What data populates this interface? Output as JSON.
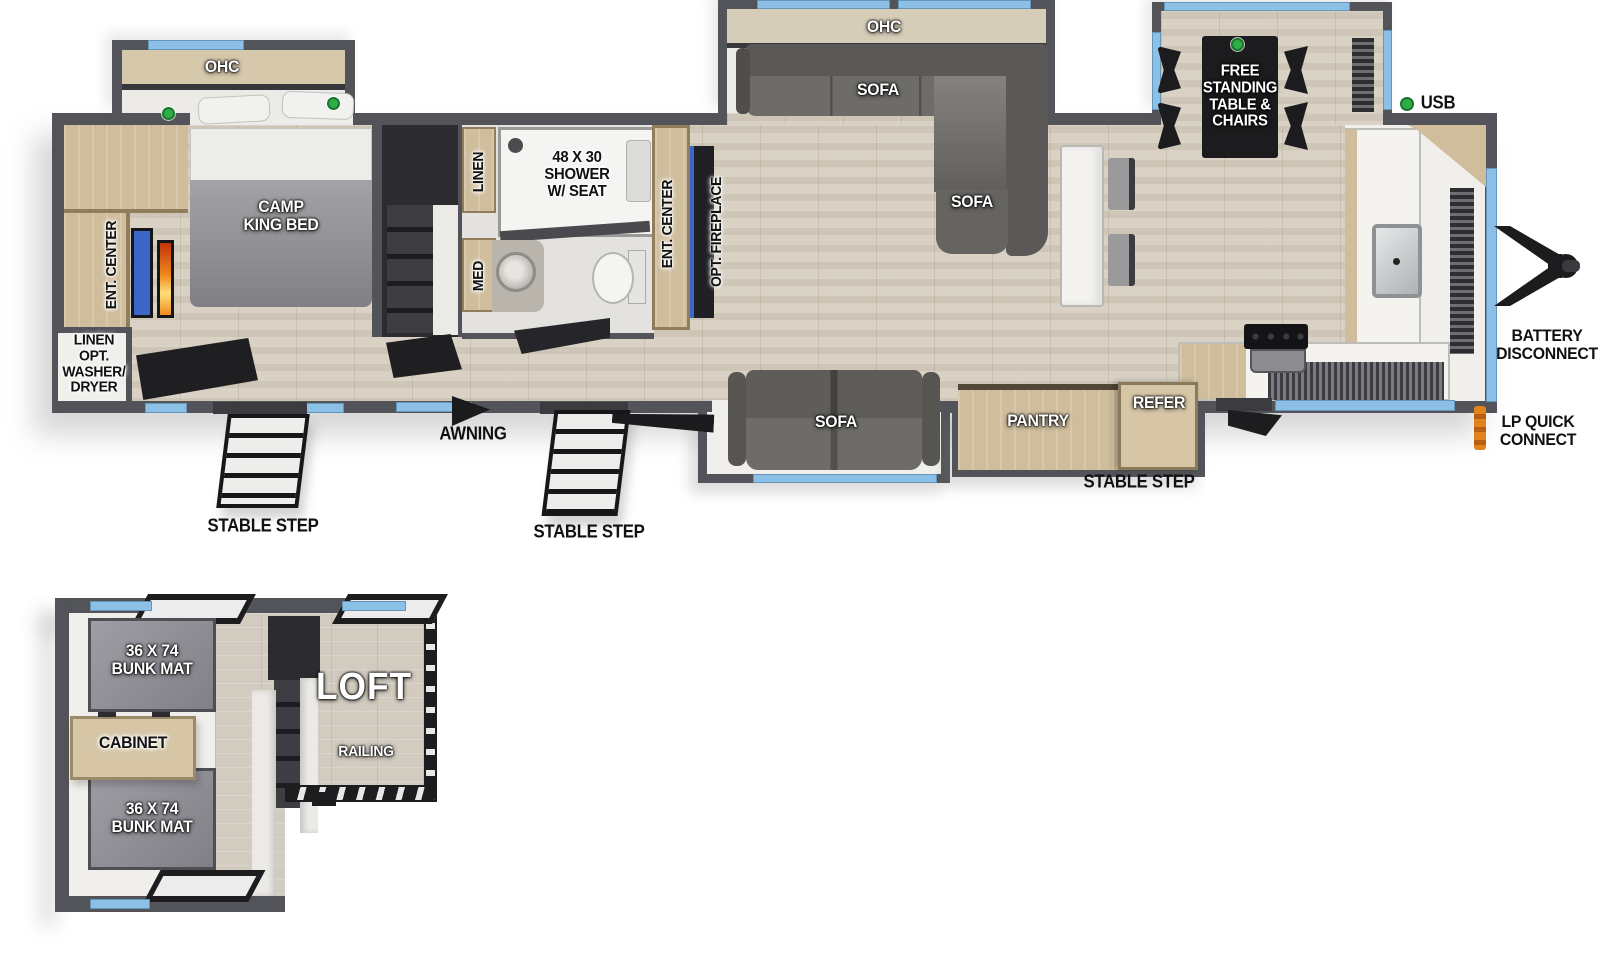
{
  "diagram": "travel-trailer-floorplan-two-levels",
  "colors": {
    "wall": "#535459",
    "window_blue": "#8cc0e6",
    "usb_green": "#2fae47",
    "wood_floor": "#d8d1c4",
    "cabinet_tan": "#cfbd9c",
    "sofa_gray": "#6e6c69",
    "bunk_gray": "#8e8e96",
    "table_black": "#1c1c1e",
    "fireplace_blue": "#3b66c9",
    "flame_orange": "#f08a1d",
    "lp_orange": "#e2821c"
  },
  "labels": {
    "ohc": "OHC",
    "camp_king_bed": "CAMP\nKING BED",
    "ent_center": "ENT. CENTER",
    "linen_opt_washer_dryer": "LINEN\nOPT.\nWASHER/\nDRYER",
    "linen": "LINEN",
    "med": "MED",
    "shower": "48 X 30\nSHOWER\nW/ SEAT",
    "opt_fireplace": "OPT. FIREPLACE",
    "sofa": "SOFA",
    "free_standing_table": "FREE\nSTANDING\nTABLE &\nCHAIRS",
    "usb": "USB",
    "pantry": "PANTRY",
    "refer": "REFER",
    "awning": "AWNING",
    "stable_step": "STABLE STEP",
    "battery_disconnect": "BATTERY\nDISCONNECT",
    "lp_quick_connect": "LP QUICK\nCONNECT",
    "bunk_mat": "36 X 74\nBUNK MAT",
    "cabinet": "CABINET",
    "loft": "LOFT",
    "railing": "RAILING"
  }
}
